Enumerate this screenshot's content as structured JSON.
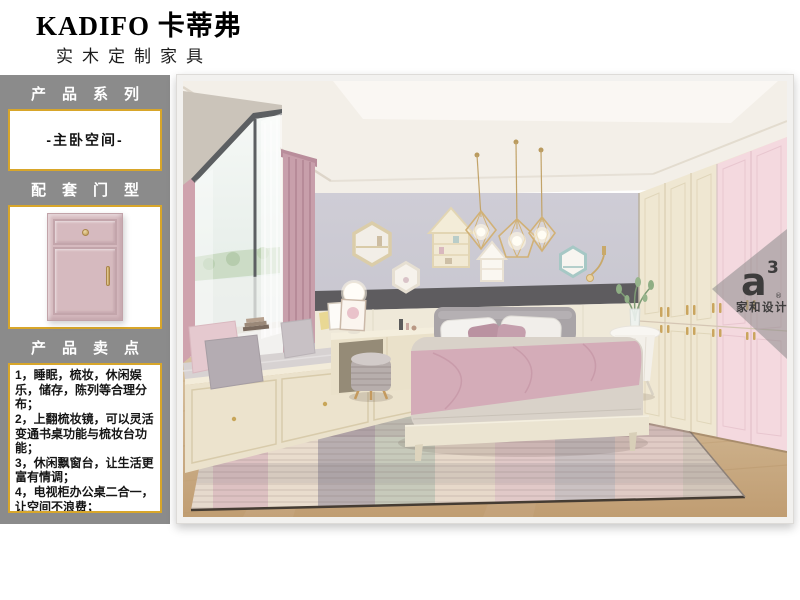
{
  "header": {
    "brand": "KADIFO 卡蒂弗",
    "subtitle": "实木定制家具"
  },
  "sidebar": {
    "series_label": "产品系列",
    "series_value": "-主卧空间-",
    "door_label": "配套门型",
    "selling_label": "产品卖点",
    "selling_points": [
      "1，睡眠，梳妆，休闲娱乐，储存，陈列等合理分布；",
      "2，上翻梳妆镜，可以灵活变通书桌功能与梳妆台功能；",
      "3，休闲飘窗台，让生活更富有情调；",
      "4，电视柜办公桌二合一，让空间不浪费；"
    ]
  },
  "watermark": {
    "logo_a": "a",
    "logo_exp": "3",
    "logo_reg": "®",
    "logo_sub": "家和设计"
  },
  "colors": {
    "accent_gold": "#D8A62A",
    "sidebar_gray": "#8B8B8B",
    "door_pink": "#D6BABF",
    "wall_lavender": "#C9C8D2",
    "wardrobe_cream": "#EFE7D2",
    "wardrobe_pink": "#F4D9DF",
    "blanket_pink": "#D4ACB8",
    "floor_wood": "#CDAE86"
  }
}
